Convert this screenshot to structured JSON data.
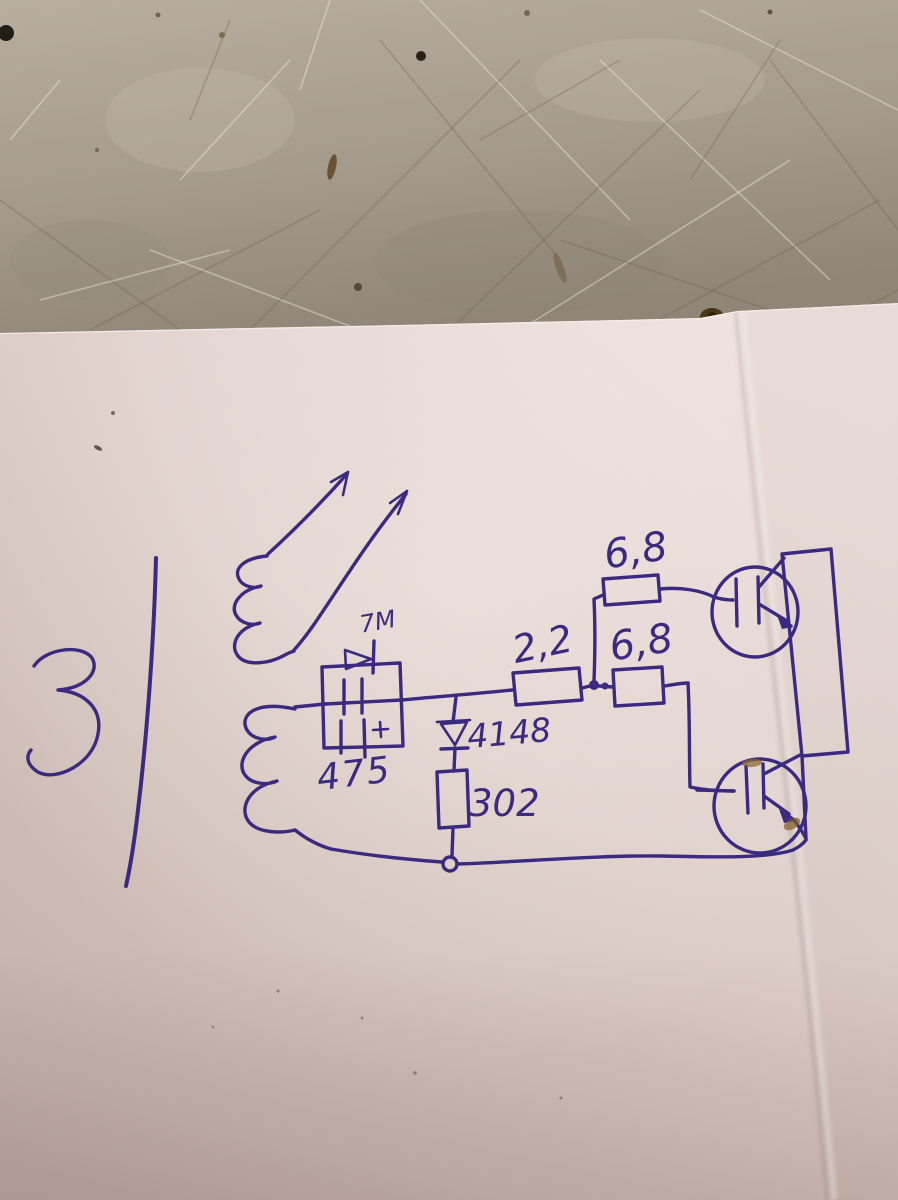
{
  "colors": {
    "ink": "#3b2b80",
    "paper_light": "#ecdfdc",
    "paper_dark": "#c2b0a8",
    "bench_light": "#b5ac9d",
    "bench_dark": "#948b7c",
    "stain_brown": "#5f4724"
  },
  "schematic": {
    "labels": {
      "rectifier_marking": "7M",
      "capacitor_code": "475",
      "clamp_diode": "4148",
      "lower_resistor": "302",
      "series_resistor": "2,2",
      "upper_gate_resistor": "6,8",
      "lower_gate_resistor": "6,8"
    }
  }
}
